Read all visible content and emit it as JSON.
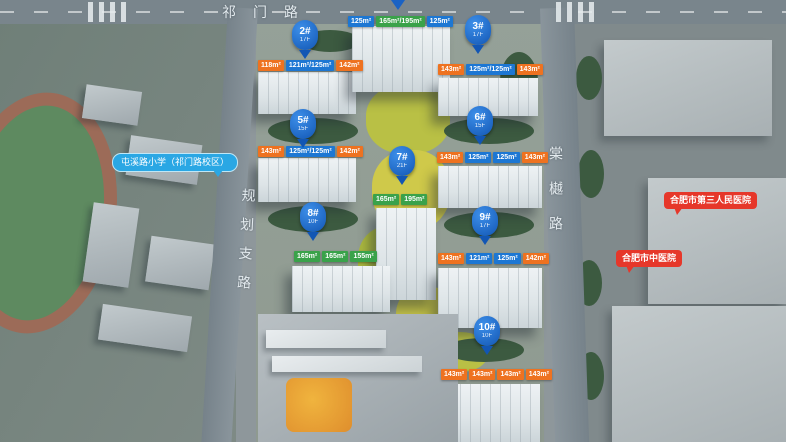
{
  "roads": {
    "top_label": "祁门路",
    "left_label": "规划支路",
    "right_label": "棠樾路"
  },
  "poi": {
    "school_label": "屯溪路小学（祁门路校区）",
    "hospital_a_label": "合肥市第三人民医院",
    "hospital_b_label": "合肥市中医院"
  },
  "colors": {
    "pin_blue": "#1a62c4",
    "unit_orange": "#ee7220",
    "unit_blue": "#1d77d3",
    "unit_green": "#3aa24a",
    "school_bubble_blue": "#2aa7e4",
    "hospital_bubble_red": "#e6372a"
  },
  "buildings": [
    {
      "id": "top-row",
      "pin": "",
      "floors": "",
      "units": [
        {
          "area": "125m²",
          "color": "blue"
        },
        {
          "area": "165m²/195m²",
          "color": "green"
        },
        {
          "area": "125m²",
          "color": "blue"
        }
      ]
    },
    {
      "id": "2#",
      "pin": "2#",
      "floors": "17F",
      "units": [
        {
          "area": "118m²",
          "color": "orange"
        },
        {
          "area": "121m²/125m²",
          "color": "blue"
        },
        {
          "area": "142m²",
          "color": "orange"
        }
      ]
    },
    {
      "id": "3#",
      "pin": "3#",
      "floors": "17F",
      "units": [
        {
          "area": "143m²",
          "color": "orange"
        },
        {
          "area": "125m²/125m²",
          "color": "blue"
        },
        {
          "area": "143m²",
          "color": "orange"
        }
      ]
    },
    {
      "id": "5#",
      "pin": "5#",
      "floors": "15F",
      "units": [
        {
          "area": "143m²",
          "color": "orange"
        },
        {
          "area": "125m²/125m²",
          "color": "blue"
        },
        {
          "area": "142m²",
          "color": "orange"
        }
      ]
    },
    {
      "id": "6#",
      "pin": "6#",
      "floors": "15F",
      "units": [
        {
          "area": "143m²",
          "color": "orange"
        },
        {
          "area": "125m²",
          "color": "blue"
        },
        {
          "area": "125m²",
          "color": "blue"
        },
        {
          "area": "143m²",
          "color": "orange"
        }
      ]
    },
    {
      "id": "7#",
      "pin": "7#",
      "floors": "21F",
      "units": [
        {
          "area": "165m²",
          "color": "green"
        },
        {
          "area": "195m²",
          "color": "green"
        }
      ]
    },
    {
      "id": "8#",
      "pin": "8#",
      "floors": "10F",
      "units": [
        {
          "area": "165m²",
          "color": "green"
        },
        {
          "area": "165m²",
          "color": "green"
        },
        {
          "area": "155m²",
          "color": "green"
        }
      ]
    },
    {
      "id": "9#",
      "pin": "9#",
      "floors": "17F",
      "units": [
        {
          "area": "143m²",
          "color": "orange"
        },
        {
          "area": "121m²",
          "color": "blue"
        },
        {
          "area": "125m²",
          "color": "blue"
        },
        {
          "area": "142m²",
          "color": "orange"
        }
      ]
    },
    {
      "id": "10#",
      "pin": "10#",
      "floors": "10F",
      "units": [
        {
          "area": "143m²",
          "color": "orange"
        },
        {
          "area": "143m²",
          "color": "orange"
        },
        {
          "area": "143m²",
          "color": "orange"
        },
        {
          "area": "143m²",
          "color": "orange"
        }
      ]
    }
  ]
}
